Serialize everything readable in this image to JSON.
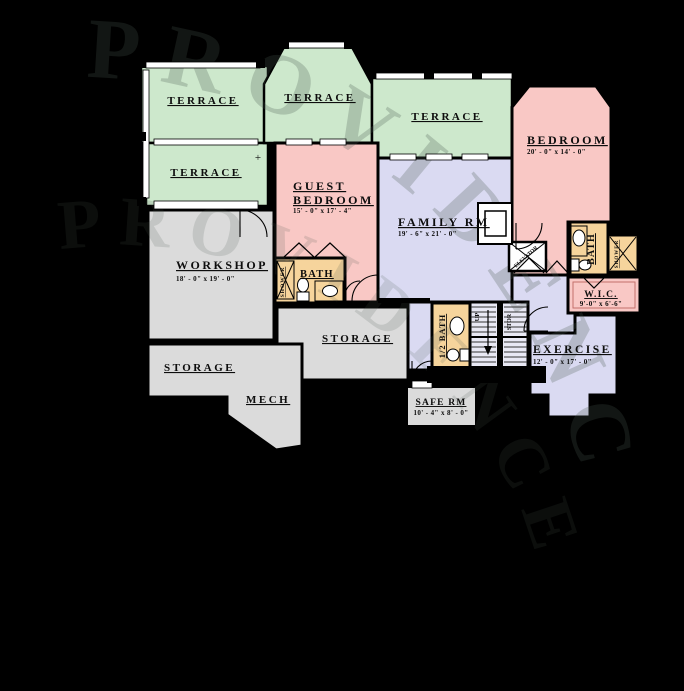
{
  "plan": {
    "watermark": "PROVIDENCE",
    "watermark2": "PROVIDENCE",
    "rooms": {
      "terrace_top_left": {
        "label": "TERRACE"
      },
      "terrace_mid_left": {
        "label": "TERRACE"
      },
      "terrace_top_middle": {
        "label": "TERRACE"
      },
      "terrace_top_right": {
        "label": "TERRACE"
      },
      "guest_bedroom": {
        "label_line1": "GUEST",
        "label_line2": "BEDROOM",
        "dims": "15' - 0\" x 17' - 4\""
      },
      "bedroom": {
        "label": "BEDROOM",
        "dims": "20' - 0\" x 14' - 0\""
      },
      "family_room": {
        "label": "FAMILY RM",
        "dims": "19' - 6\" x 21' - 0\""
      },
      "workshop": {
        "label": "WORKSHOP",
        "dims": "18' - 0\" x 19' - 0\""
      },
      "bath_guest": {
        "label": "BATH",
        "shower": "SHOWER"
      },
      "bath_right": {
        "label": "BATH",
        "shower": "SHOWER"
      },
      "half_bath": {
        "label": "1/2 BATH"
      },
      "storage_middle": {
        "label": "STORAGE"
      },
      "storage_left": {
        "label": "STORAGE"
      },
      "mech": {
        "label": "MECH"
      },
      "safe_room": {
        "label": "SAFE RM",
        "dims": "10' - 4\" x 8' - 0\""
      },
      "exercise": {
        "label": "EXERCISE",
        "dims": "12' - 0\" x 17' - 0\""
      },
      "wic": {
        "label": "W.I.C.",
        "dims": "9'-0\" x 6'-6\""
      }
    },
    "stairs": {
      "up": "UP",
      "stor": "STOR"
    },
    "elevator": {
      "label": "ELEVATOR"
    },
    "plus_marker": "+",
    "colors": {
      "terrace": "#cde8cc",
      "bedroom": "#f9c8c5",
      "living": "#dadaf2",
      "utility": "#dbdbdb",
      "bath": "#f6d49c",
      "background": "#000000"
    }
  }
}
